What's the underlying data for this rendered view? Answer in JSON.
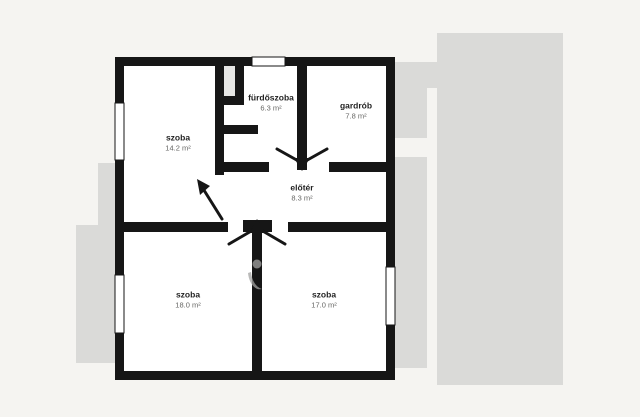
{
  "rooms": [
    {
      "id": "szoba-top-left",
      "name": "szoba",
      "area": "14.2 m²"
    },
    {
      "id": "furdoszoba",
      "name": "fürdőszoba",
      "area": "6.3 m²"
    },
    {
      "id": "gardrob",
      "name": "gardrób",
      "area": "7.8 m²"
    },
    {
      "id": "eloter",
      "name": "előtér",
      "area": "8.3 m²"
    },
    {
      "id": "szoba-bottom-left",
      "name": "szoba",
      "area": "18.0 m²"
    },
    {
      "id": "szoba-bottom-right",
      "name": "szoba",
      "area": "17.0 m²"
    }
  ],
  "colors": {
    "background": "#f5f4f1",
    "neighbor_gray": "#dadad8",
    "wall": "#161616",
    "interior": "#ffffff"
  }
}
